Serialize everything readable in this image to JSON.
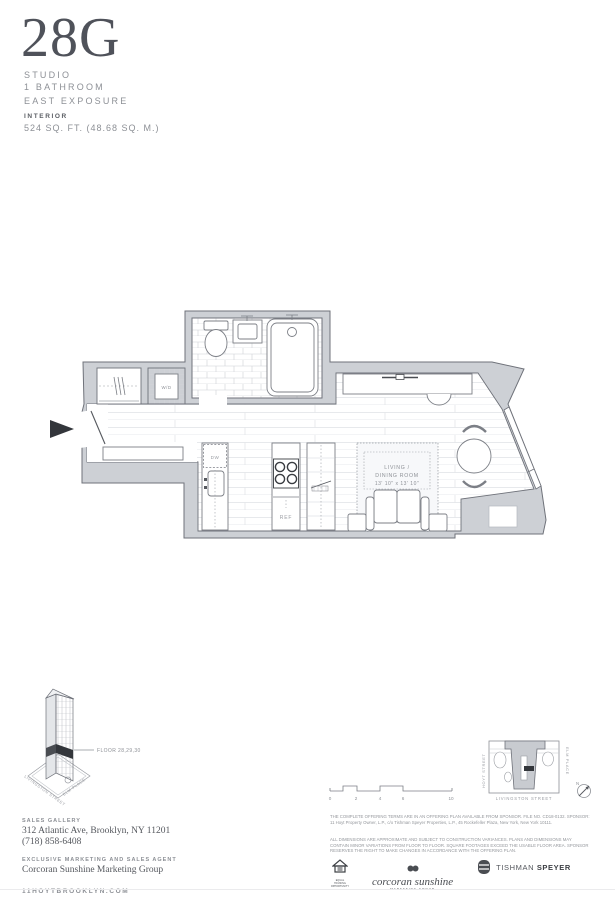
{
  "header": {
    "unit": "28G",
    "unit_type": "STUDIO",
    "bathrooms": "1 BATHROOM",
    "exposure": "EAST EXPOSURE",
    "category": "INTERIOR",
    "area": "524 SQ. FT. (48.68 SQ. M.)"
  },
  "plan": {
    "labels": {
      "washer_dryer": "W/D",
      "dishwasher": "DW",
      "refrigerator": "REF",
      "living_line1": "LIVING /",
      "living_line2": "DINING ROOM",
      "living_dims": "13' 10\" x 13' 10\""
    }
  },
  "building_key": {
    "floor_label": "FLOOR 28,29,30",
    "street_left": "LIVINGSTON STREET",
    "street_right": "ELM PLACE"
  },
  "scale_bar": {
    "ticks": [
      "0",
      "2",
      "4",
      "6",
      "10"
    ]
  },
  "site_map": {
    "street_left": "HOYT STREET",
    "street_right": "ELM PLACE",
    "street_bottom": "LIVINGSTON STREET",
    "north": "N"
  },
  "footer": {
    "sales_gallery_label": "SALES GALLERY",
    "address": "312 Atlantic Ave, Brooklyn, NY 11201",
    "phone": "(718) 858-6408",
    "agent_label": "EXCLUSIVE MARKETING AND SALES AGENT",
    "agent": "Corcoran Sunshine Marketing Group",
    "website": "11HOYTBROOKLYN.COM",
    "disclaimer1": "THE COMPLETE OFFERING TERMS ARE IN AN OFFERING PLAN AVAILABLE FROM SPONSOR. FILE NO. CD18-0132. SPONSOR: 11 Hoyt Property Owner, L.P., c/o Tishman Speyer Properties, L.P., 45 Rockefeller Plaza, New York, New York 10111.",
    "disclaimer2": "ALL DIMENSIONS ARE APPROXIMATE AND SUBJECT TO CONSTRUCTION VARIANCES. PLANS AND DIMENSIONS MAY CONTAIN MINOR VARIATIONS FROM FLOOR TO FLOOR. SQUARE FOOTAGES EXCEED THE USABLE FLOOR AREA. SPONSOR RESERVES THE RIGHT TO MAKE CHANGES IN ACCORDANCE WITH THE OFFERING PLAN.",
    "logos": {
      "equal_housing_caption": "EQUAL HOUSING OPPORTUNITY",
      "corcoran_script": "corcoran sunshine",
      "corcoran_caption": "MARKETING GROUP",
      "tishman": "TISHMAN",
      "speyer": "SPEYER"
    }
  }
}
